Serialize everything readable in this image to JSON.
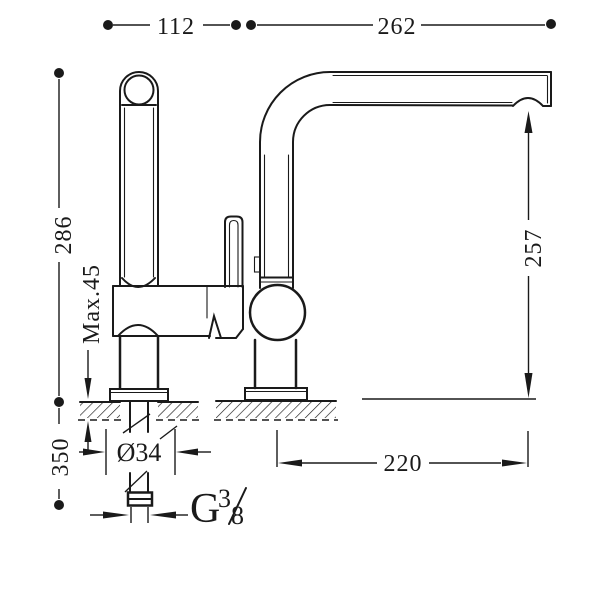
{
  "colors": {
    "ink": "#1a1a1a",
    "background": "#ffffff"
  },
  "dimensions": {
    "top_left_width": "112",
    "top_right_reach": "262",
    "height_above_deck": "286",
    "max_deck_thickness": "Max.45",
    "hose_length_below": "350",
    "spout_outlet_height": "257",
    "spout_projection": "220",
    "deck_hole_diameter": "Ø34",
    "thread_letter": "G",
    "thread_numerator": "3",
    "thread_denominator": "8"
  }
}
